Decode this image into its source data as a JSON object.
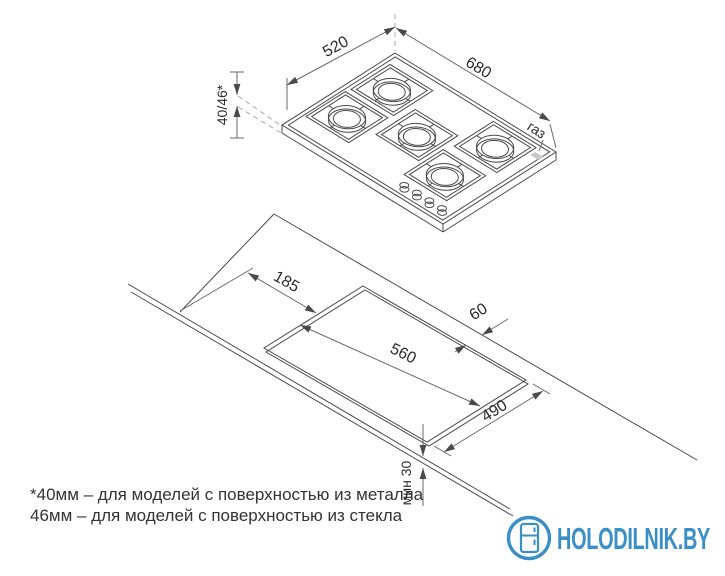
{
  "page": {
    "background": "#ffffff"
  },
  "colors": {
    "drawing_line": "#4a4a4a",
    "dimension_text": "#2b2b2b",
    "logo_blue": "#3a8fc7",
    "gas_inlet_fill": "#c8c8c8"
  },
  "top_view": {
    "dim_depth": "520",
    "dim_width": "680",
    "dim_height": "40/46*",
    "gas_label": "газ"
  },
  "cutout_view": {
    "dim_left_offset": "185",
    "dim_back_gap": "60",
    "dim_cut_width": "560",
    "dim_cut_depth": "490",
    "dim_front_min": "мин 30"
  },
  "footnote": {
    "line1": "*40мм – для моделей с поверхностью из металла",
    "line2": "46мм – для моделей с поверхностью из стекла"
  },
  "logo": {
    "text": "HOLODILNIK.BY"
  }
}
